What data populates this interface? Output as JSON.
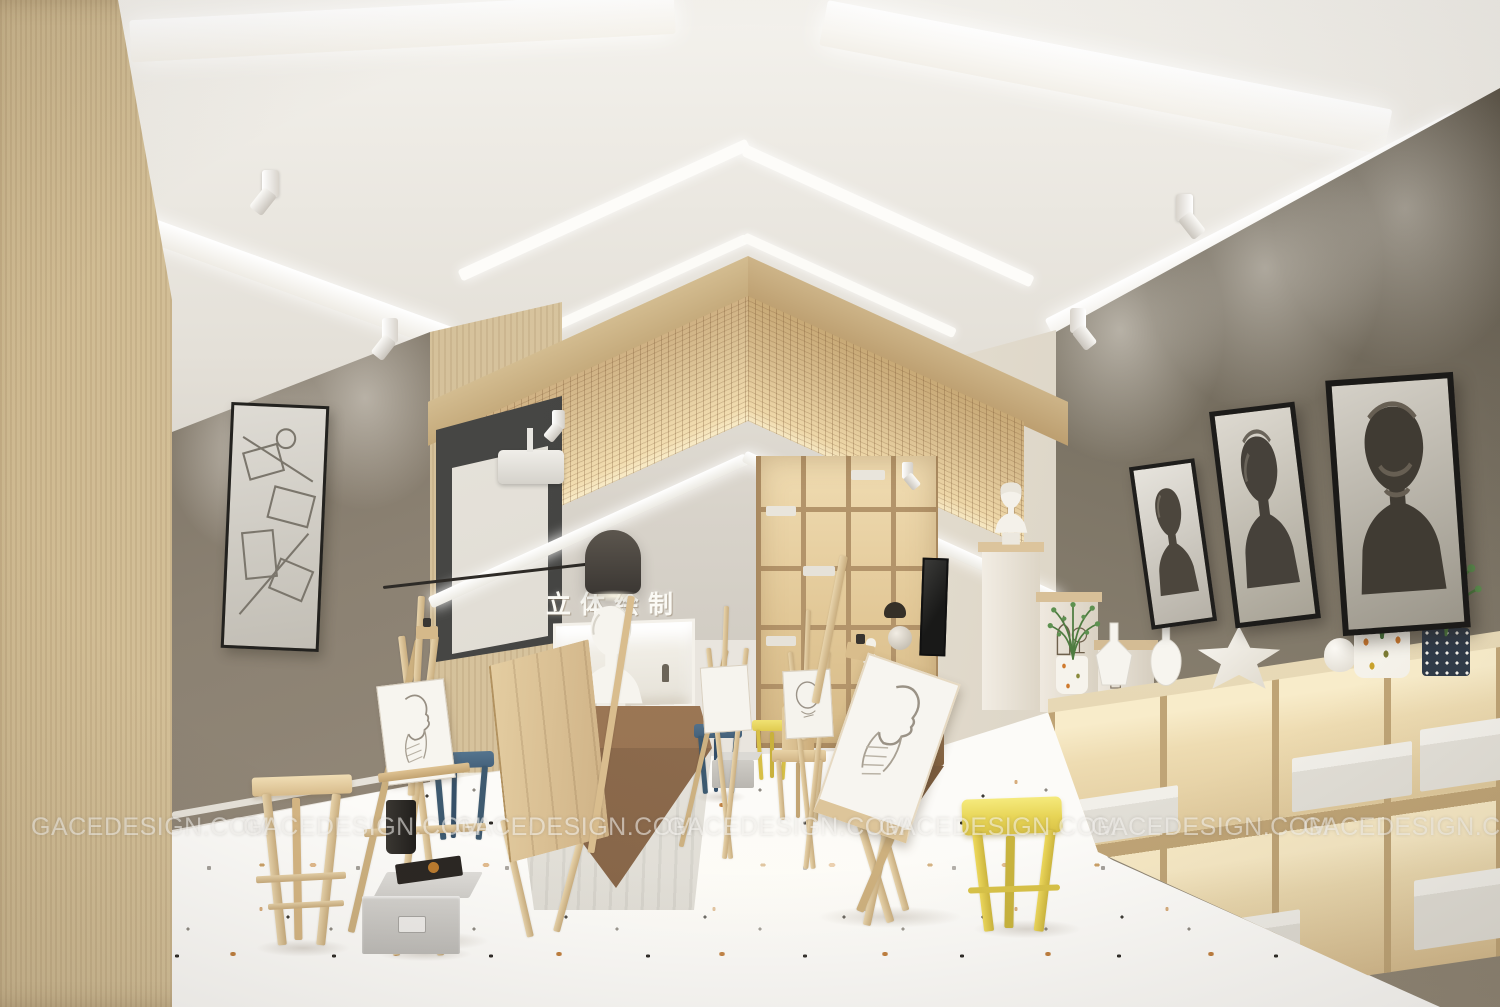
{
  "watermark": {
    "text": "GACEDESIGN.COM",
    "instances": 7
  },
  "sign": {
    "text": "立体绘制"
  },
  "palette": {
    "ceiling_white": "#efece6",
    "gable_grille_wood": "#dcc092",
    "wall_wood_light": "#dccaa6",
    "wall_taupe_left": "#8f8477",
    "wall_gray_right": "#847b6c",
    "screen_panel_dark": "#474644",
    "floor_terrazzo_base": "#fcfbf8",
    "chip_black": "#2e2b27",
    "chip_amber": "#c07f3e",
    "chip_tan": "#d7ad7d",
    "stool_yellow": "#eedd66",
    "stool_blue": "#4b697f",
    "lamp_dark": "#4a4540",
    "plant_green": "#558648"
  },
  "objects": [
    "vaulted-ceiling",
    "wood-grille-gable",
    "recessed-light-strips",
    "track-spotlights",
    "projection-screen",
    "projector",
    "wall-arm-lamp",
    "display-niche",
    "plaster-busts",
    "sketch-easels",
    "framed-sketches",
    "staircase-display",
    "cubby-counter",
    "terrazzo-floor",
    "wood-stool",
    "yellow-stools",
    "blue-stools",
    "wooden-chairs",
    "storage-box",
    "plants",
    "white-vases",
    "star-sculpture"
  ]
}
